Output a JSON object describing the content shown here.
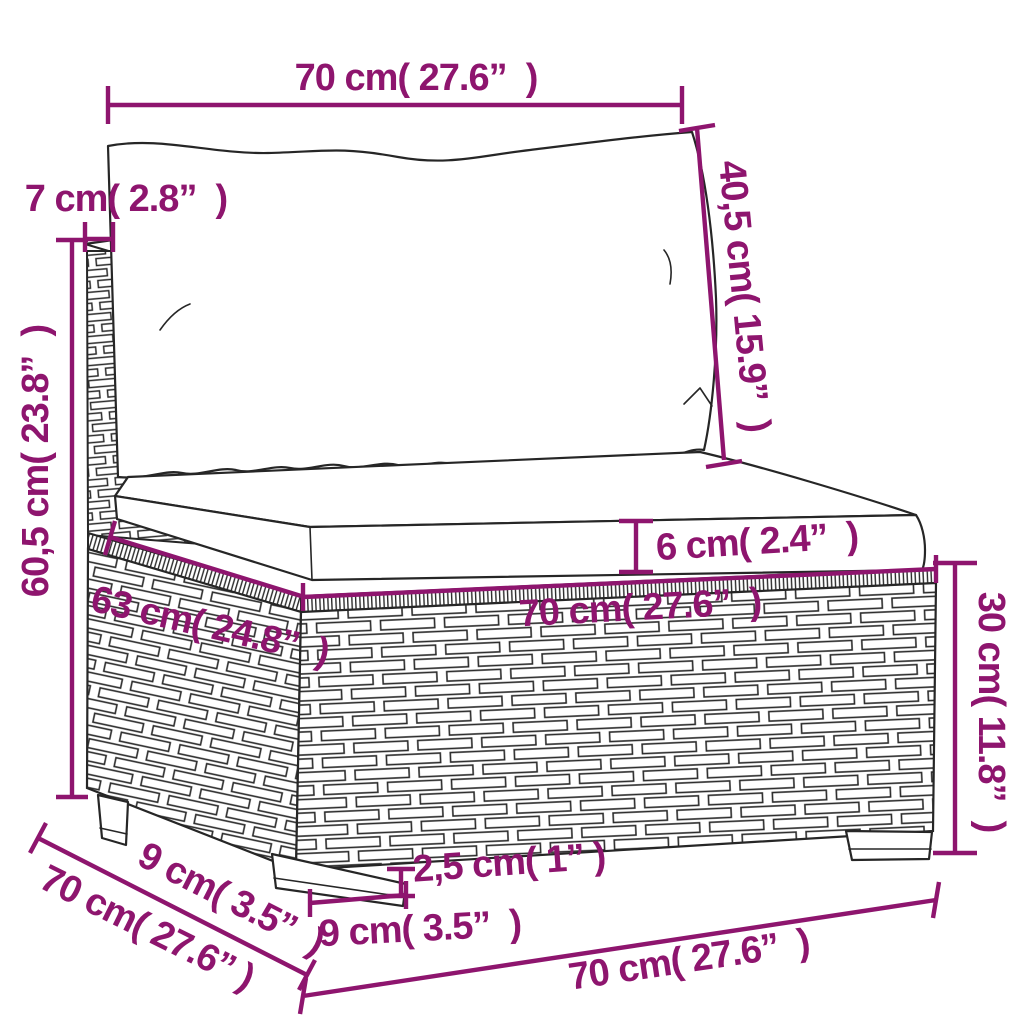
{
  "title": "Rattan sofa section dimension diagram",
  "style": {
    "accent_color": "#8e156e",
    "line_color": "#262626",
    "background": "#ffffff"
  },
  "product": {
    "description": "poly rattan sofa middle section with back cushion and seat cushion, line drawing with wicker weave texture"
  },
  "labels": {
    "back_width": "70 cm( 27.6”  )",
    "back_cushion_height": "40,5 cm( 15.9”  )",
    "frame_thickness": "7 cm( 2.8”  )",
    "total_height": "60,5 cm( 23.8”  )",
    "seat_cushion_thickness": "6 cm( 2.4”  )",
    "seat_width": "70 cm( 27.6”  )",
    "seat_depth": "63 cm( 24.8”  )",
    "base_height": "30 cm( 11.8”  )",
    "foot_height": "2,5 cm( 1” )",
    "leg_width": "9 cm( 3.5”  )",
    "leg_depth": "9 cm( 3.5”  )",
    "overall_depth": "70 cm( 27.6” )",
    "overall_width": "70 cm( 27.6”  )"
  }
}
